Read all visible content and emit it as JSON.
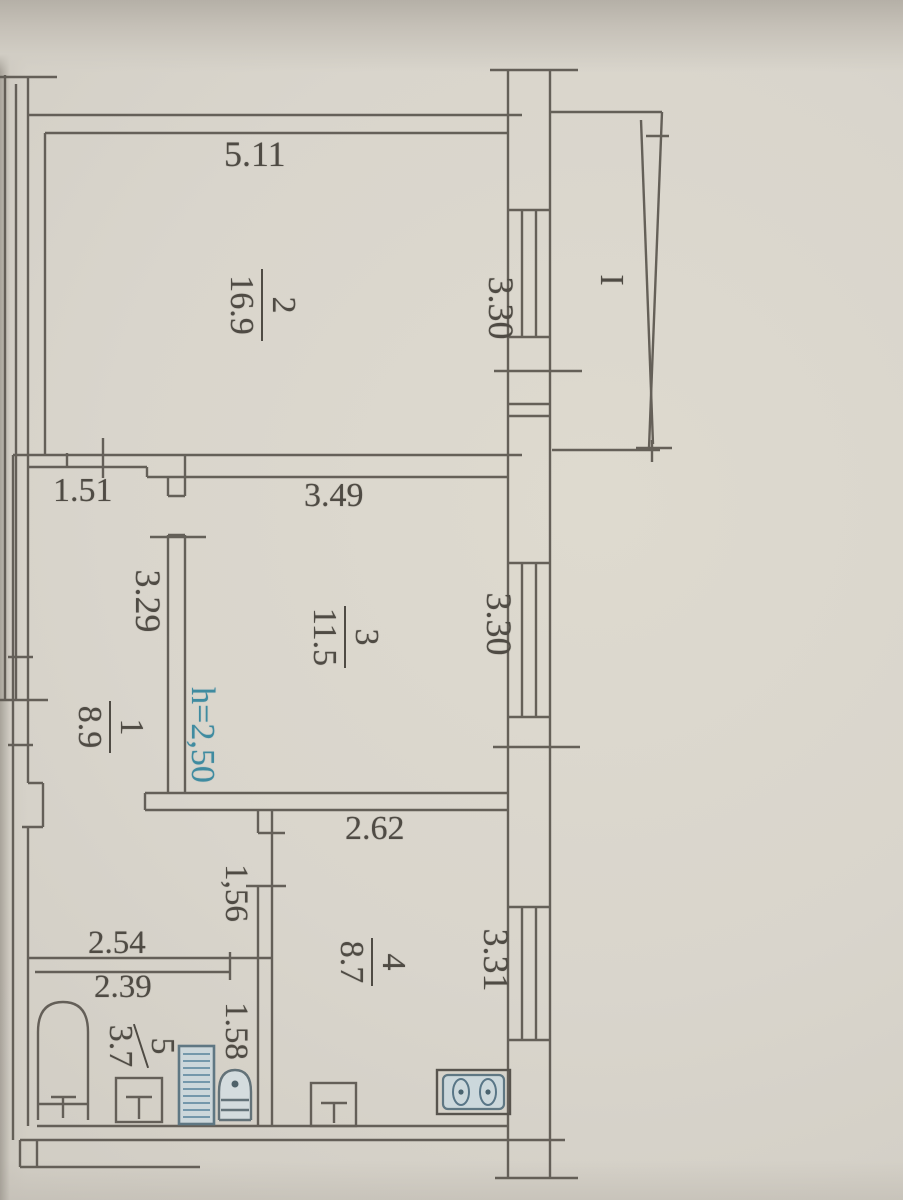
{
  "rooms": {
    "r1": {
      "num": "1",
      "area": "8.9"
    },
    "r2": {
      "num": "2",
      "area": "16.9"
    },
    "r3": {
      "num": "3",
      "area": "11.5"
    },
    "r4": {
      "num": "4",
      "area": "8.7"
    },
    "r5": {
      "num": "5",
      "area": "3.7"
    }
  },
  "dims": {
    "room2_top": "5.11",
    "corridor_top": "1.51",
    "room3_top": "3.49",
    "hall_top": "2.62",
    "bath_above": "2.54",
    "bath_top": "2.39",
    "room2_window": "3.30",
    "room3_window": "3.30",
    "kitchen_window": "3.31",
    "corridor_side": "3.29",
    "hall_side": "1,56",
    "bath_side": "1.58"
  },
  "notes": {
    "ceiling_height": "h=2,50",
    "balcony_mark": "I"
  },
  "colors": {
    "paper": "#d6d2c9",
    "ink": "#55504a",
    "blue_ink": "#3f8ba0",
    "fixture_blue": "#55707e"
  }
}
